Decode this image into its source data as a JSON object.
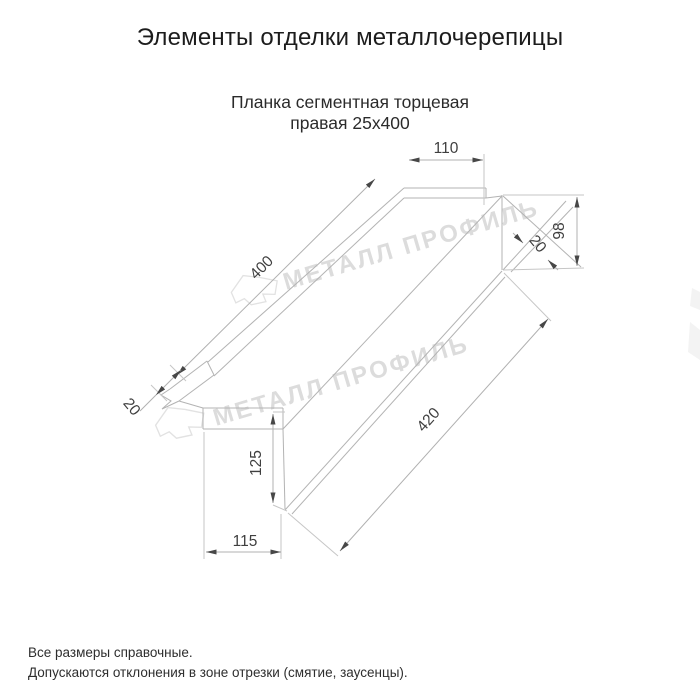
{
  "page": {
    "title": "Элементы отделки металлочерепицы"
  },
  "drawing": {
    "subtitle_line1": "Планка сегментная торцевая",
    "subtitle_line2": "правая 25х400",
    "dimensions": {
      "top_tab_width": "110",
      "end_height": "98",
      "end_fold": "20",
      "top_length": "400",
      "bottom_length": "420",
      "left_fold": "20",
      "left_height": "125",
      "bottom_width": "115"
    },
    "watermark": {
      "text": "МЕТАЛЛ ПРОФИЛЬ",
      "color": "#dcdcdc",
      "logo": "metal-profil-logo"
    },
    "line_color": "#b3b3b3",
    "dim_text_color": "#3f3f3f"
  },
  "footer": {
    "line1": "Все размеры справочные.",
    "line2": "Допускаются отклонения в зоне отрезки (смятие, заусенцы)."
  }
}
